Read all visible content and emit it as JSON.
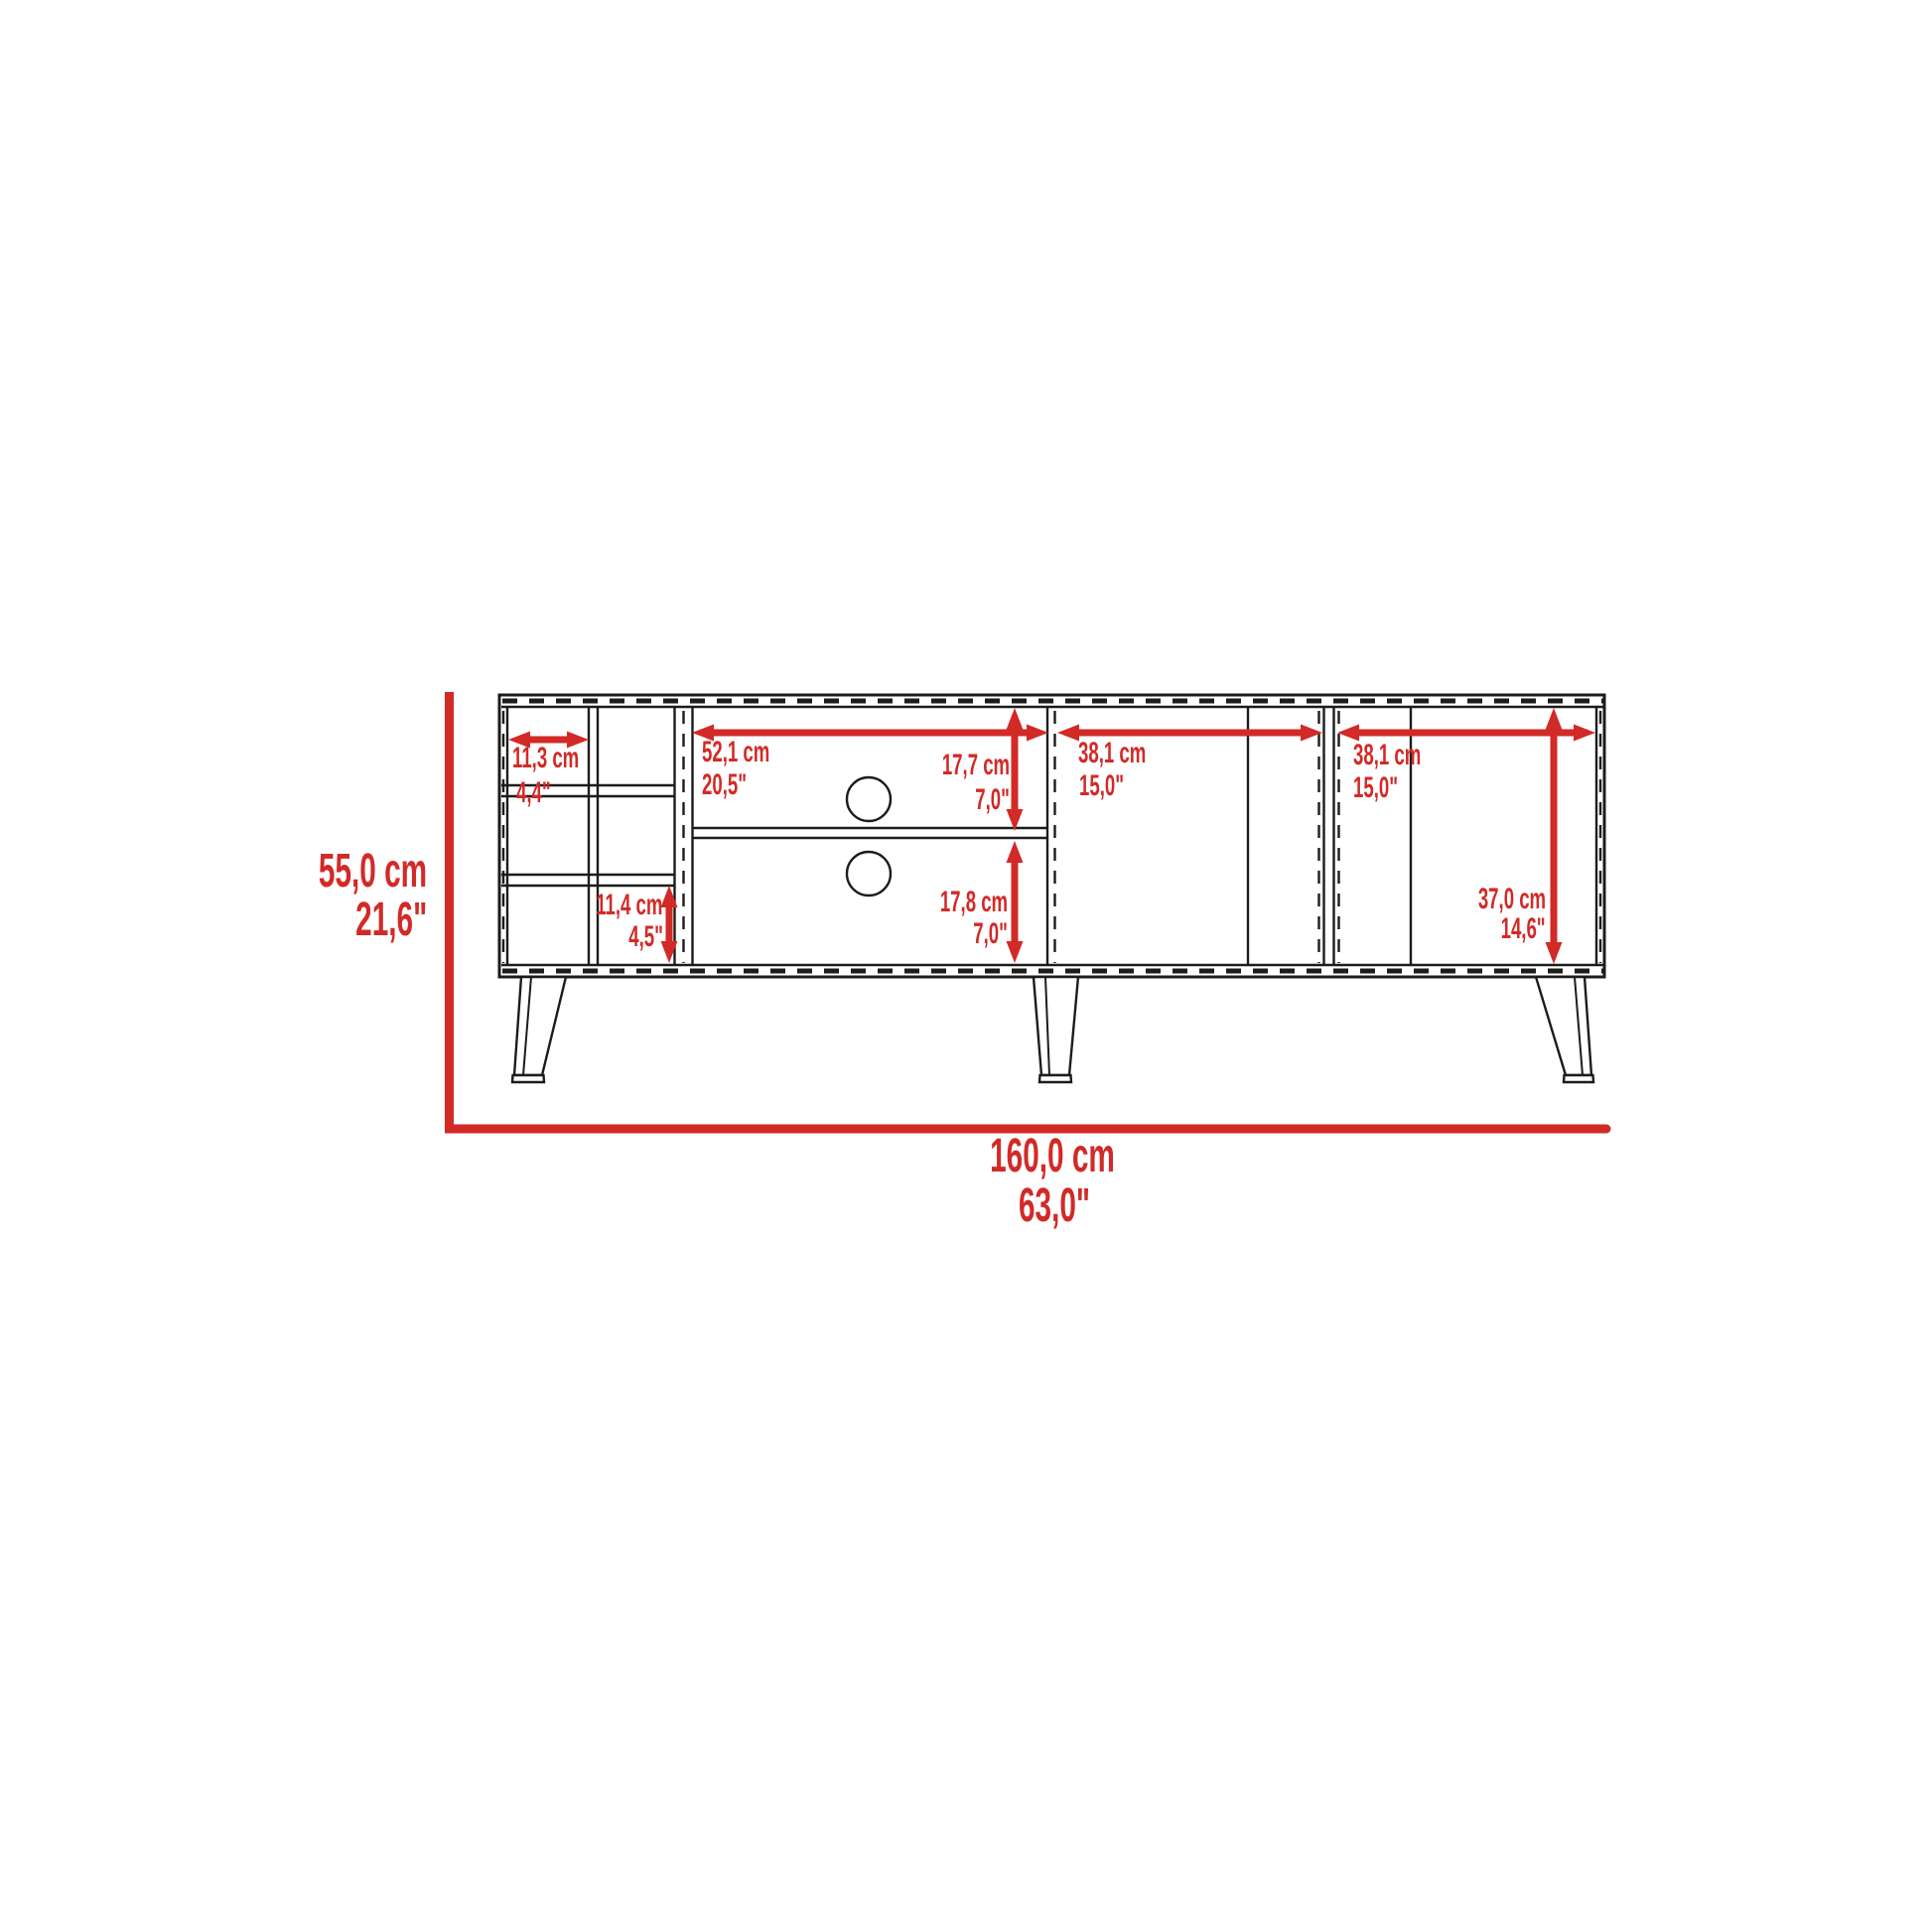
{
  "colors": {
    "dimension_red": "#d22a27",
    "line_black": "#1c1c1a",
    "background": "#ffffff"
  },
  "diagram": {
    "type": "furniture-dimension-drawing",
    "subject": "tv-stand front elevation with wine cubbies, open media shelves, two door cabinets and splayed legs"
  },
  "dimensions": {
    "overall_width_cm": "160,0 cm",
    "overall_width_in": "63,0\"",
    "overall_height_cm": "55,0 cm",
    "overall_height_in": "21,6\"",
    "cubby_width_cm": "11,3 cm",
    "cubby_width_in": "4,4\"",
    "cubby_height_cm": "11,4 cm",
    "cubby_height_in": "4,5\"",
    "media_width_cm": "52,1 cm",
    "media_width_in": "20,5\"",
    "upper_compartment_height_cm": "17,7 cm",
    "upper_compartment_height_in": "7,0\"",
    "lower_compartment_height_cm": "17,8 cm",
    "lower_compartment_height_in": "7,0\"",
    "left_door_width_cm": "38,1 cm",
    "left_door_width_in": "15,0\"",
    "right_door_width_cm": "38,1 cm",
    "right_door_width_in": "15,0\"",
    "door_interior_height_cm": "37,0 cm",
    "door_interior_height_in": "14,6\""
  }
}
